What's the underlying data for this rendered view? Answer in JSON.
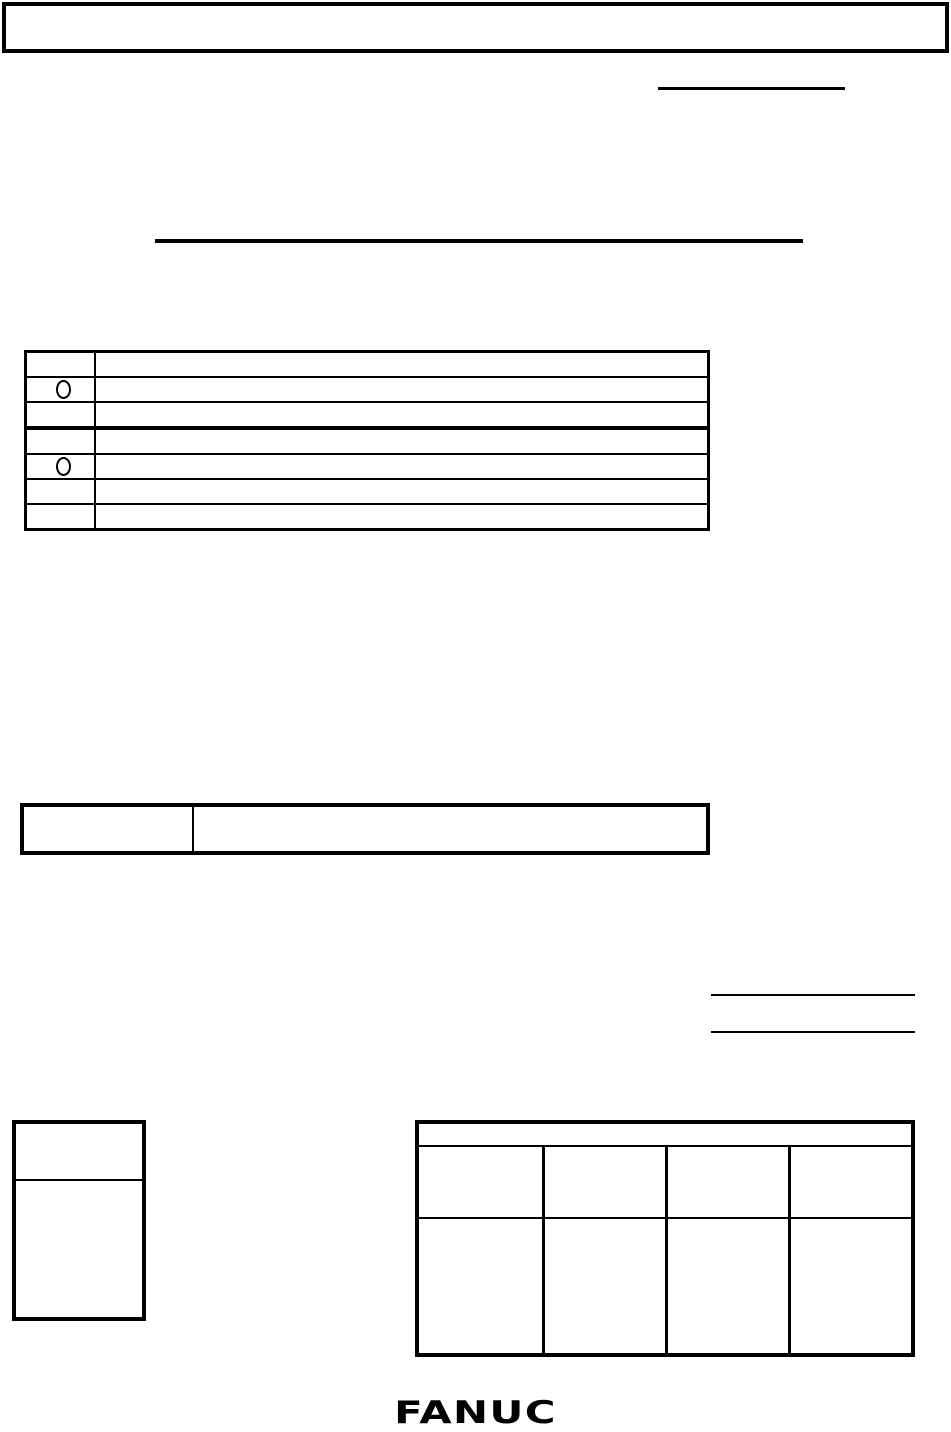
{
  "colors": {
    "ink": "#000000",
    "paper": "#ffffff"
  },
  "header_box": {
    "text": ""
  },
  "top_right_underline": {
    "text_above": ""
  },
  "title_underline": {
    "text_above": ""
  },
  "revision_table": {
    "rows": [
      {
        "mark": "",
        "text": ""
      },
      {
        "mark": "circle",
        "text": ""
      },
      {
        "mark": "",
        "text": ""
      },
      {
        "mark": "",
        "text": ""
      },
      {
        "mark": "circle",
        "text": ""
      },
      {
        "mark": "",
        "text": ""
      },
      {
        "mark": "",
        "text": ""
      }
    ]
  },
  "label_value_table": {
    "label": "",
    "value": ""
  },
  "signature_lines": {
    "line1": "",
    "line2": ""
  },
  "side_box": {
    "top_cell": "",
    "bottom_cell": ""
  },
  "approval_table": {
    "header": "",
    "rows": [
      [
        "",
        "",
        "",
        ""
      ],
      [
        "",
        "",
        "",
        ""
      ]
    ]
  },
  "logo": {
    "text": "FANUC"
  }
}
